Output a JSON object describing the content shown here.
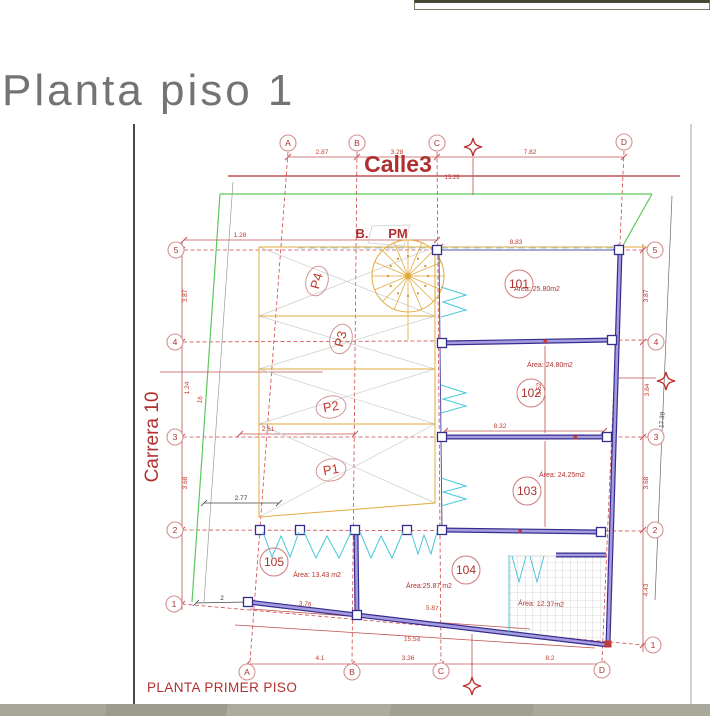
{
  "window": {
    "title": "Planta piso 1",
    "caption": "PLANTA PRIMER PISO"
  },
  "plan": {
    "streets": {
      "top": "Calle3",
      "left": "Carrera 10"
    },
    "annotations": {
      "bpm_prefix": "B.",
      "bpm": "PM"
    },
    "grid": {
      "cols": [
        "A",
        "B",
        "C",
        "D"
      ],
      "rows": [
        "1",
        "2",
        "3",
        "4",
        "5"
      ]
    },
    "units": [
      {
        "id": "101",
        "area_label": "Área: 25.80m2"
      },
      {
        "id": "102",
        "area_label": "Área: 24.80m2"
      },
      {
        "id": "103",
        "area_label": "Área: 24.25m2"
      },
      {
        "id": "104",
        "area_label": "Área:25.87 m2"
      },
      {
        "id": "105",
        "area_label": "Área: 13.43 m2"
      }
    ],
    "patio": {
      "area_label": "Área: 12.37m2"
    },
    "parking": {
      "stalls": [
        "P1",
        "P2",
        "P3",
        "P4"
      ]
    },
    "dims": {
      "top_ab": "2.87",
      "top_bc": "3.28",
      "top_cd": "7.82",
      "street_total": "15.29",
      "g5_inner": "1.28",
      "g5_cd": "8.83",
      "g3_left": "2.61",
      "g3_span": "8.32",
      "left_5_4": "3.87",
      "left_4_3": "1.24",
      "left_3_2": "3.68",
      "left_slope": "16",
      "right_5_4": "3.87",
      "right_4_3": "3.84",
      "right_3_2": "3.68",
      "right_2_1": "4.43",
      "right_slope": "17.39",
      "room_depth": "3.52",
      "black_a": "2.77",
      "black_b": "2",
      "wall_b1": "3.76",
      "wall_b2": "5.87",
      "wall_total": "15.54",
      "bot_ab": "4.1",
      "bot_bc": "3.36",
      "bot_cd": "8.2"
    }
  },
  "colors": {
    "drawing_red": "#b03030",
    "wall_purple": "#372d8e",
    "parking_yellow": "#e2a93c",
    "door_cyan": "#49c8d8",
    "boundary_green": "#5dc85d",
    "title_gray": "#737373",
    "footer_olive": "#a5a496"
  }
}
